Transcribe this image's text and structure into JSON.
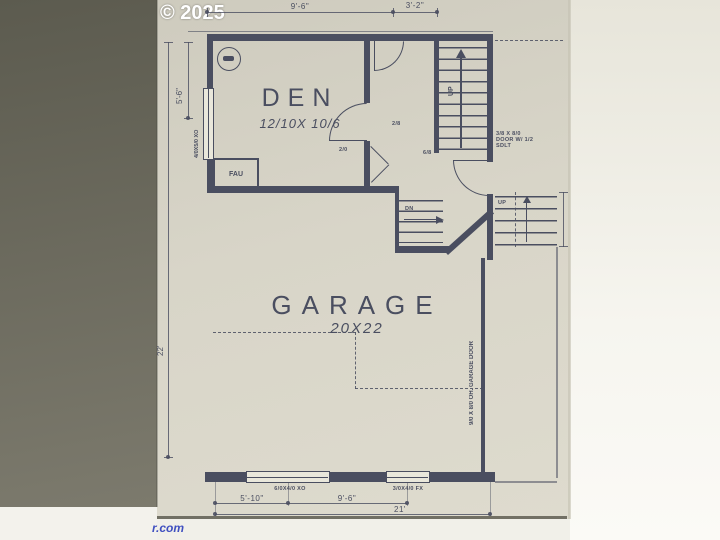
{
  "watermark": {
    "copyright": "© 2025",
    "site_fragment": "r.com"
  },
  "rooms": {
    "den": {
      "name": "DEN",
      "size": "12/10X 10/6"
    },
    "garage": {
      "name": "GARAGE",
      "size": "20X22"
    }
  },
  "annotations": {
    "fau": "FAU",
    "stairs_up": "UP",
    "garage_steps_dn": "DN",
    "porch_steps_up": "UP",
    "den_window": "4/0X5/0 XO",
    "bottom_window_left": "6/0X4/0 XO",
    "bottom_window_right": "3/0X4/0 FX",
    "garage_door": "9/0 X 8/0 OH. GARAGE DOOR",
    "entry_door_note_line1": "3/8 X 8/0",
    "entry_door_note_line2": "DOOR W/ 1/2",
    "entry_door_note_line3": "SDLT",
    "den_door_size": "2/0",
    "hall_door_size": "2/8",
    "entry_door_size": "6/8"
  },
  "dimensions": {
    "top_left": "9'-6\"",
    "top_right": "3'-2\"",
    "left_upper": "5'-6\"",
    "left_total": "22'",
    "bottom_left": "5'-10\"",
    "bottom_mid": "9'-6\"",
    "bottom_total": "21'"
  },
  "colors": {
    "ink": "#4a4e60",
    "paper": "#d8d5c8",
    "watermark_blue": "#4050c0"
  }
}
